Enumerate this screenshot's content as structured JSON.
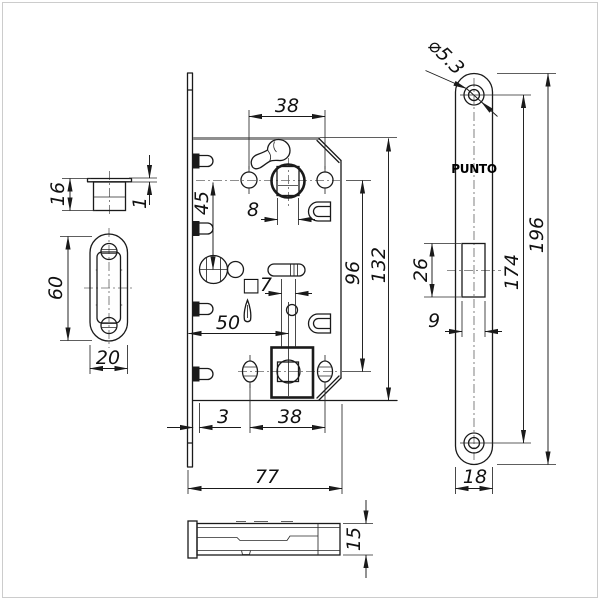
{
  "brand": "PUNTO",
  "views": {
    "striker_side": {
      "height": "16",
      "flange_thickness": "1"
    },
    "striker_front": {
      "height": "60",
      "width": "20"
    },
    "body_front": {
      "backset_top": "38",
      "handle_square": "8",
      "hub_to_cylinder": "45",
      "screw_span": "96",
      "height": "132",
      "wc_square": "□7",
      "wc_backset": "50",
      "front_offset": "3",
      "backset_bottom": "38",
      "depth": "77"
    },
    "faceplate": {
      "hole_diameter": "⌀5.3",
      "cutout_height": "26",
      "cutout_width": "9",
      "screw_span": "174",
      "length": "196",
      "width": "18"
    },
    "body_bottom": {
      "thickness": "15"
    }
  }
}
